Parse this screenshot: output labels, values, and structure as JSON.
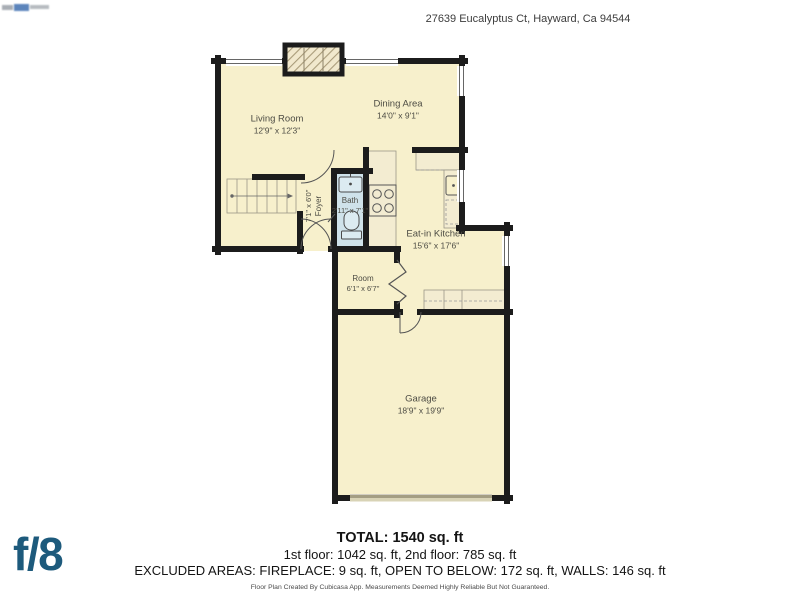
{
  "header": {
    "address": "27639 Eucalyptus Ct, Hayward, Ca 94544"
  },
  "branding": {
    "logo_text": "f/8"
  },
  "floorplan": {
    "rooms": {
      "living": {
        "name": "Living Room",
        "dims": "12'9\" x 12'3\""
      },
      "dining": {
        "name": "Dining Area",
        "dims": "14'0\" x 9'1\""
      },
      "foyer": {
        "name": "Foyer",
        "dims": "7'1\" x 6'0\""
      },
      "bath": {
        "name": "Bath",
        "dims": "2'11\" x 7'1\""
      },
      "kitchen": {
        "name": "Eat-in Kitchen",
        "dims": "15'6\" x 17'6\""
      },
      "room": {
        "name": "Room",
        "dims": "6'1\" x 6'7\""
      },
      "garage": {
        "name": "Garage",
        "dims": "18'9\" x 19'9\""
      }
    }
  },
  "summary": {
    "total": "TOTAL: 1540 sq. ft",
    "floors": "1st floor: 1042 sq. ft, 2nd floor: 785 sq. ft",
    "excluded": "EXCLUDED AREAS: FIREPLACE: 9 sq. ft, OPEN TO BELOW: 172 sq. ft, WALLS: 146 sq. ft",
    "disclaimer": "Floor Plan Created By Cubicasa App. Measurements Deemed Highly Reliable But Not Guaranteed."
  },
  "colors": {
    "floor": "#f7f0cc",
    "wall": "#1c1c1c",
    "bath_floor": "#cfe2ea",
    "logo_blue": "#1d5a7c"
  }
}
